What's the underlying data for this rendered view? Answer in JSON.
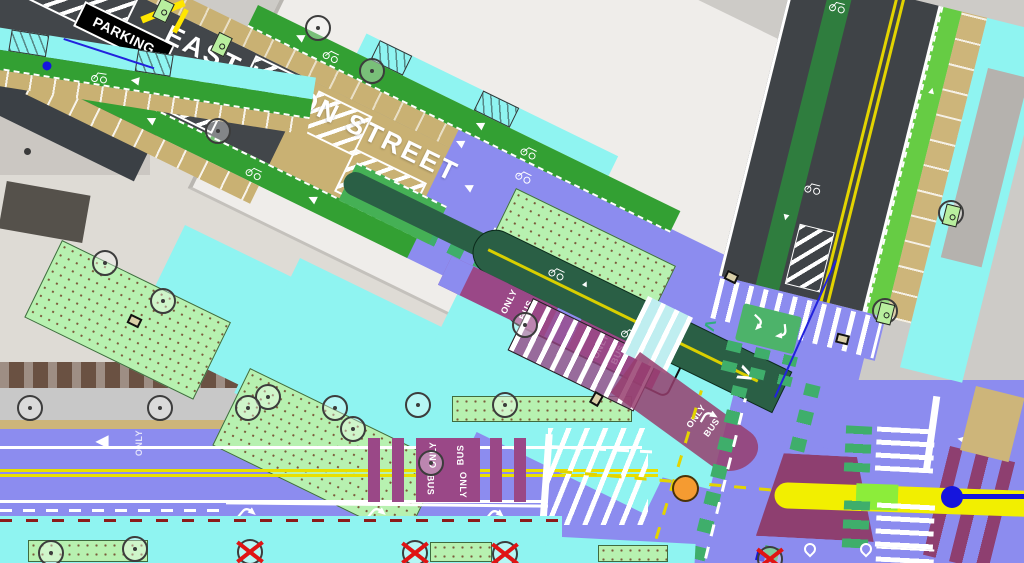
{
  "map_labels": {
    "street_name": "EAST UNION STREET",
    "parking_sign": "PARKING",
    "bus_only_word1": "ONLY",
    "bus_only_word2": "BUS",
    "only_marking": "ONLY"
  },
  "glyphs": {
    "chevron_right": ">",
    "chevron_left": "<",
    "arrow_left": "◀",
    "arrow_up": "▲",
    "arrow_down": "▼"
  },
  "colors": {
    "roadway_purple": "#8c8cef",
    "sidewalk_cyan": "#8ff4f1",
    "cycletrack_dark_green": "#2a5f45",
    "bike_lane_green": "#33a033",
    "bike_lane_light_green": "#66cc44",
    "bike_crossing_green": "#3fae6b",
    "landscape_green": "#b7f1b0",
    "turn_box_green": "#4db36a",
    "bus_lane_maroon": "#9a4887",
    "bus_trapezoid_maroon": "#8e3f70",
    "parking_tan": "#cdb57a",
    "asphalt_gray": "#42464a",
    "centerline_yellow": "#e3d400",
    "transit_band_yellow": "#f2ef00",
    "transit_band_lime": "#8ced3a",
    "transit_line_blue": "#1515dd",
    "intersection_marker_orange": "#f59b31",
    "removed_tree_red": "#e01414"
  }
}
